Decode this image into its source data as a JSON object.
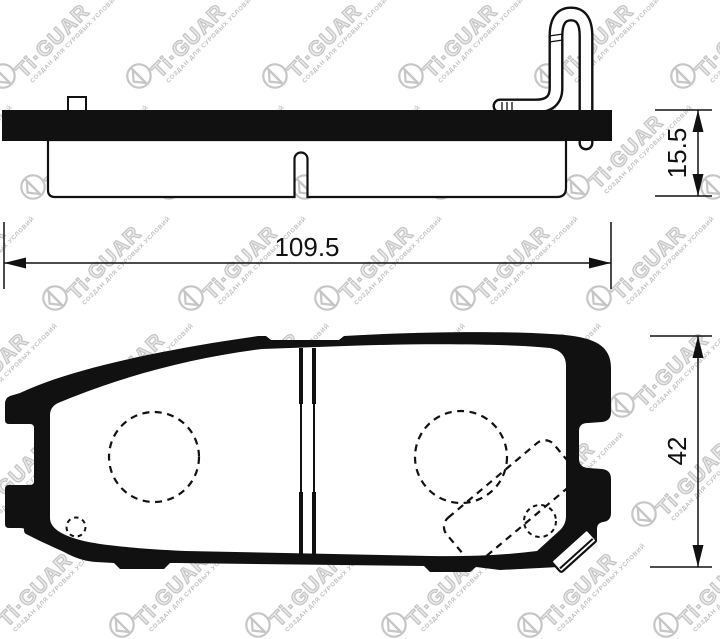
{
  "document": {
    "type": "brake-pad-technical-drawing",
    "background": "#ffffff",
    "ink_color": "#111111"
  },
  "watermark": {
    "brand": "Ti·GUAR",
    "slogan": "СОЗДАН ДЛЯ СУРОВЫХ УСЛОВИЙ",
    "color": "#c4c4c4"
  },
  "views": {
    "side_profile": {
      "dimensions": {
        "length_mm": "109.5",
        "thickness_mm": "15.5"
      }
    },
    "pad_face": {
      "dimensions": {
        "height_mm": "42"
      }
    }
  }
}
